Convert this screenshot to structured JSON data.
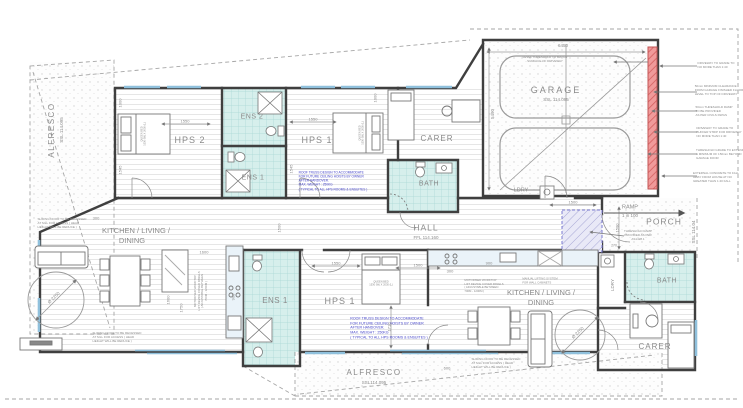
{
  "colors": {
    "wall": "#3f3f3f",
    "wet_area_fill": "#d6efec",
    "wet_area_grid": "#a9d8d4",
    "garage_door_red": "#e98a8a",
    "threshold_ramp_blue": "#7a7ad0",
    "note_blue": "#4444c8",
    "annotation_gray": "#8a8a8a",
    "window_cyan": "#8fc0dc"
  },
  "labels": [
    {
      "name": "label-alfresco-left-title",
      "text": "ALFRESCO",
      "x": 52,
      "y": 130,
      "size": 8,
      "rot": -90,
      "ls": 1.5
    },
    {
      "name": "label-alfresco-left-ssl",
      "text": "SSL 114.095",
      "x": 62,
      "y": 130,
      "size": 4.5,
      "rot": -90
    },
    {
      "name": "label-hps2",
      "text": "HPS 2",
      "x": 190,
      "y": 141,
      "size": 9,
      "ls": 1
    },
    {
      "name": "label-ens2",
      "text": "ENS 2",
      "x": 252,
      "y": 117,
      "size": 7,
      "ls": 0.5
    },
    {
      "name": "label-ens1-top",
      "text": "ENS 1",
      "x": 253,
      "y": 178,
      "size": 7,
      "ls": 0.5
    },
    {
      "name": "label-hps1-top",
      "text": "HPS 1",
      "x": 317,
      "y": 141,
      "size": 9,
      "ls": 1
    },
    {
      "name": "label-carer-top",
      "text": "CARER",
      "x": 437,
      "y": 139,
      "size": 8,
      "ls": 1
    },
    {
      "name": "label-bath-top",
      "text": "BATH",
      "x": 429,
      "y": 184,
      "size": 7,
      "ls": 0.5
    },
    {
      "name": "label-garage",
      "text": "GARAGE",
      "x": 556,
      "y": 91,
      "size": 9,
      "ls": 2
    },
    {
      "name": "label-garage-ssl",
      "text": "SSL 114.095",
      "x": 556,
      "y": 100,
      "size": 4.5
    },
    {
      "name": "label-ldry-top",
      "text": "LDRY",
      "x": 521,
      "y": 191,
      "size": 5.5
    },
    {
      "name": "label-hall",
      "text": "HALL",
      "x": 426,
      "y": 228,
      "size": 8.5,
      "ls": 1
    },
    {
      "name": "label-hall-ffl",
      "text": "FFL 114.160",
      "x": 426,
      "y": 238,
      "size": 4.5
    },
    {
      "name": "label-ramp",
      "text": "RAMP",
      "x": 630,
      "y": 208,
      "size": 5.5
    },
    {
      "name": "label-ramp-grade",
      "text": "1 in 100",
      "x": 630,
      "y": 216,
      "size": 4.5
    },
    {
      "name": "label-porch",
      "text": "PORCH",
      "x": 664,
      "y": 222,
      "size": 8.5,
      "ls": 1
    },
    {
      "name": "label-porch-ssl",
      "text": "SSL 114.04",
      "x": 694,
      "y": 232,
      "size": 4.5,
      "rot": -90
    },
    {
      "name": "label-kld-left-1",
      "text": "KITCHEN / LIVING /",
      "x": 136,
      "y": 231,
      "size": 7.5
    },
    {
      "name": "label-kld-left-2",
      "text": "DINING",
      "x": 132,
      "y": 241,
      "size": 7.5
    },
    {
      "name": "label-kld-right-1",
      "text": "KITCHEN / LIVING /",
      "x": 541,
      "y": 293,
      "size": 7.5
    },
    {
      "name": "label-kld-right-2",
      "text": "DINING",
      "x": 541,
      "y": 303,
      "size": 7.5
    },
    {
      "name": "label-ens1-bottom",
      "text": "ENS 1",
      "x": 275,
      "y": 301,
      "size": 8,
      "ls": 0.5
    },
    {
      "name": "label-hps1-bottom",
      "text": "HPS 1",
      "x": 340,
      "y": 302,
      "size": 9,
      "ls": 1
    },
    {
      "name": "label-bath-bottom",
      "text": "BATH",
      "x": 667,
      "y": 281,
      "size": 7,
      "ls": 0.5
    },
    {
      "name": "label-carer-bottom",
      "text": "CARER",
      "x": 655,
      "y": 347,
      "size": 8,
      "ls": 1
    },
    {
      "name": "label-ldry-bottom",
      "text": "LDRY",
      "x": 613,
      "y": 285,
      "size": 4.5,
      "rot": -90
    },
    {
      "name": "label-alfresco-bottom-title",
      "text": "ALFRESCO",
      "x": 374,
      "y": 373,
      "size": 8,
      "ls": 1.5
    },
    {
      "name": "label-alfresco-bottom-ssl",
      "text": "SSL114.095",
      "x": 374,
      "y": 383,
      "size": 4.5
    },
    {
      "name": "label-bed-hps2",
      "lines": [
        "QUEEN BED",
        "1530 (W) X 2030 (L)"
      ],
      "x": 144,
      "y": 134,
      "size": 2.6,
      "rot": -90
    },
    {
      "name": "label-bed-hps1-top",
      "lines": [
        "QUEEN BED",
        "1530 (W) X 2030 (L)"
      ],
      "x": 362,
      "y": 133,
      "size": 2.6,
      "rot": -90
    },
    {
      "name": "label-bed-hps1-bottom",
      "lines": [
        "QUEEN BED",
        "1530 (W) X 2030 (L)"
      ],
      "x": 381,
      "y": 284,
      "size": 2.6
    },
    {
      "name": "note-roof-truss-top",
      "lines": [
        "ROOF TRUSS DESIGN TO ACCOMMODATE",
        "FOR FUTURE CEILING HOISTS BY OWNER",
        "AFTER HANDOVER.",
        "MAX. WEIGHT : 250KG",
        "( TYPICAL TO ALL HPS ROOMS & ENSUITES )"
      ],
      "x": 333,
      "y": 181,
      "size": 3.2,
      "color": "#4444c8",
      "align": "left"
    },
    {
      "name": "note-roof-truss-bottom",
      "lines": [
        "ROOF TRUSS DESIGN TO ACCOMMODATE",
        "FOR FUTURE CEILING HOISTS BY OWNER",
        "AFTER HANDOVER.",
        "MAX. WEIGHT : 250KG",
        "( TYPICAL TO ALL HPS ROOMS & ENSUITES )"
      ],
      "x": 389,
      "y": 328,
      "size": 3.6,
      "color": "#4444c8",
      "align": "left"
    },
    {
      "name": "note-sliding-door-top-left",
      "lines": [
        "SLIDING DOOR TO BE RECESSED",
        "AT SILL FOR ACCESS ( HEAD",
        "HEIGHT WILL BE REDUCE )"
      ],
      "x": 62,
      "y": 224,
      "size": 3,
      "align": "left"
    },
    {
      "name": "note-sliding-door-bottom-left",
      "lines": [
        "SLIDING DOOR TO BE RECESSED",
        "AT SILL FOR ACCESS ( HEAD",
        "HEIGHT WILL BE REDUCE )"
      ],
      "x": 117,
      "y": 338,
      "size": 3,
      "align": "left"
    },
    {
      "name": "note-sliding-door-bottom-right",
      "lines": [
        "SLIDING DOOR TO BE RECESSED",
        "AT SILL FOR ACCESS ( HEAD",
        "HEIGHT WILL BE REDUCE )"
      ],
      "x": 496,
      "y": 364,
      "size": 3,
      "align": "left"
    },
    {
      "name": "note-motorised-worktop-left",
      "lines": [
        "MOTORISED WORKTOP",
        "LIFT DEVICE COVER PANELS",
        "( ADJUSTABLE BETWEEN",
        "700M - 1200M )"
      ],
      "x": 201,
      "y": 291,
      "size": 2.8,
      "rot": -90
    },
    {
      "name": "note-motorised-worktop-right",
      "lines": [
        "MOTORISED WORKTOP",
        "LIFT DEVICE COVER PANELS",
        "( ADJUSTABLE BETWEEN",
        "700M - 1200M )"
      ],
      "x": 484,
      "y": 286,
      "size": 2.8,
      "align": "left"
    },
    {
      "name": "note-manual-lifting-right",
      "lines": [
        "MANUAL LIFTING SYSTEM",
        "FOR WALL CABINETS"
      ],
      "x": 540,
      "y": 281,
      "size": 2.8,
      "align": "left"
    },
    {
      "name": "note-threshold-ramp",
      "lines": [
        "THRESHOLD RAMP",
        "PROVIDED AS PER",
        "AS1428.1"
      ],
      "x": 638,
      "y": 236,
      "size": 3
    },
    {
      "name": "note-garage-floor",
      "lines": [
        "LEVEL THRESHOLD TO MATCH",
        "SURFACE OF DRIVEWAY"
      ],
      "x": 545,
      "y": 60,
      "size": 3
    },
    {
      "name": "note-driveway-grade-1",
      "lines": [
        "DRIVEWAY TO GRADE TO",
        "NO MORE THAN 1:40"
      ],
      "x": 716,
      "y": 66,
      "size": 3,
      "align": "left"
    },
    {
      "name": "note-garage-clearance",
      "lines": [
        "50mm MINIMUM CLEARANCE",
        "FROM GARAGE FINISHED FLOOR",
        "LEVEL TO TOP OF DRIVEWAY"
      ],
      "x": 719,
      "y": 91,
      "size": 3,
      "align": "left"
    },
    {
      "name": "note-threshold-ramp-civils",
      "lines": [
        "50mm THRESHOLD RAMP",
        "TO BE PROVIDED",
        "AS PER CIVILS DWGS"
      ],
      "x": 714,
      "y": 112,
      "size": 3,
      "align": "left"
    },
    {
      "name": "note-driveway-buffer",
      "lines": [
        "DRIVEWAY TO GRADE TO",
        "BUFFER STRIP FOR DRIVEWAY",
        "NO MORE THAN 1:40"
      ],
      "x": 719,
      "y": 133,
      "size": 3,
      "align": "left"
    },
    {
      "name": "note-threshold-grade",
      "lines": [
        "THRESHOLD GRADE TO EXTEND",
        "A MINIMUM OF 150mm BEYOND",
        "GARAGE DOOR"
      ],
      "x": 720,
      "y": 155,
      "size": 3,
      "align": "left"
    },
    {
      "name": "note-external-concrete",
      "lines": [
        "EXTERNAL CONCRETE TO FALL",
        "AWAY FROM HOUSE AT NO",
        "GREATER THAN 1:40 FALL"
      ],
      "x": 716,
      "y": 178,
      "size": 3,
      "align": "left"
    },
    {
      "name": "label-turning-circle-left",
      "text": "Ø 2250",
      "x": 54,
      "y": 298,
      "size": 4.5,
      "rot": -45
    },
    {
      "name": "label-turning-circle-right",
      "text": "Ø 2250",
      "x": 578,
      "y": 333,
      "size": 4.5,
      "rot": -45
    },
    {
      "name": "dim-6450",
      "text": "6450",
      "x": 563,
      "y": 46,
      "size": 4.5
    },
    {
      "name": "dim-5490",
      "text": "5490",
      "x": 493,
      "y": 114,
      "size": 4.5,
      "rot": -90
    },
    {
      "name": "dim-1000-hps2",
      "text": "1000",
      "x": 120,
      "y": 103,
      "size": 4,
      "rot": -90
    },
    {
      "name": "dim-1550-hps2",
      "text": "1550",
      "x": 185,
      "y": 121,
      "size": 4
    },
    {
      "name": "dim-1545-hps2",
      "text": "1545",
      "x": 120,
      "y": 170,
      "size": 4,
      "rot": -90
    },
    {
      "name": "dim-1550-hps1-top",
      "text": "1550",
      "x": 313,
      "y": 119,
      "size": 4
    },
    {
      "name": "dim-1000-hps1-top",
      "text": "1000",
      "x": 375,
      "y": 98,
      "size": 4,
      "rot": -90
    },
    {
      "name": "dim-1545-hps1-top",
      "text": "1545",
      "x": 291,
      "y": 169,
      "size": 4,
      "rot": -90
    },
    {
      "name": "dim-1500-hall",
      "text": "1500",
      "x": 279,
      "y": 228,
      "size": 4,
      "rot": -90
    },
    {
      "name": "dim-1600-kitchen-left",
      "text": "1600",
      "x": 204,
      "y": 252,
      "size": 4
    },
    {
      "name": "dim-1600-island",
      "text": "1600",
      "x": 168,
      "y": 300,
      "size": 4,
      "rot": -90
    },
    {
      "name": "dim-1750-island",
      "text": "1750",
      "x": 181,
      "y": 308,
      "size": 4,
      "rot": -90
    },
    {
      "name": "dim-900-left",
      "text": "900",
      "x": 233,
      "y": 297,
      "size": 4,
      "rot": -90
    },
    {
      "name": "dim-300-left",
      "text": "300",
      "x": 96,
      "y": 218,
      "size": 4
    },
    {
      "name": "dim-1550-hps1-bottom",
      "text": "1550",
      "x": 336,
      "y": 263,
      "size": 4
    },
    {
      "name": "dim-1500-hps1-bottom",
      "text": "1500",
      "x": 418,
      "y": 265,
      "size": 4
    },
    {
      "name": "dim-1710",
      "text": "1710",
      "x": 389,
      "y": 327,
      "size": 4,
      "rot": -90
    },
    {
      "name": "dim-1500-entry",
      "text": "1500",
      "x": 573,
      "y": 202,
      "size": 4
    },
    {
      "name": "dim-1500-porch",
      "text": "1500",
      "x": 617,
      "y": 228,
      "size": 4,
      "rot": -90
    },
    {
      "name": "dim-900-right",
      "text": "900",
      "x": 489,
      "y": 263,
      "size": 4
    },
    {
      "name": "dim-300-right",
      "text": "300",
      "x": 450,
      "y": 271,
      "size": 4
    },
    {
      "name": "dim-270",
      "text": "270",
      "x": 614,
      "y": 246,
      "size": 3.5
    },
    {
      "name": "dim-600",
      "text": "600",
      "x": 447,
      "y": 368,
      "size": 4
    }
  ]
}
